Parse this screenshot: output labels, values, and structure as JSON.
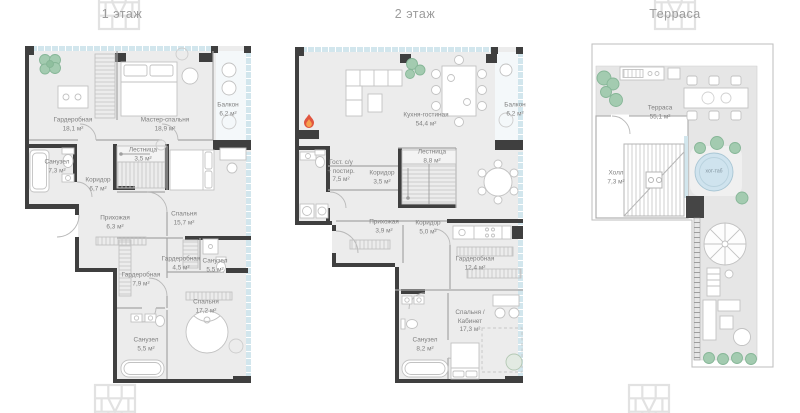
{
  "titles": {
    "floor1": "1 этаж",
    "floor2": "2 этаж",
    "terrace": "Терраса"
  },
  "floor1": {
    "rooms": [
      {
        "name": "Гардеробная",
        "area": "18,1 м²"
      },
      {
        "name": "Мастер-спальня",
        "area": "18,9 м²"
      },
      {
        "name": "Балкон",
        "area": "6,2 м²"
      },
      {
        "name": "Санузел",
        "area": "7,3 м²"
      },
      {
        "name": "Коридор",
        "area": "6,7 м²"
      },
      {
        "name": "Лестница",
        "area": "3,5 м²"
      },
      {
        "name": "Прихожая",
        "area": "6,3 м²"
      },
      {
        "name": "Спальня",
        "area": "15,7 м²"
      },
      {
        "name": "Гардеробная",
        "area": "4,5 м²"
      },
      {
        "name": "Санузел",
        "area": "5,5 м²"
      },
      {
        "name": "Гардеробная",
        "area": "7,9 м²"
      },
      {
        "name": "Спальня",
        "area": "17,2 м²"
      },
      {
        "name": "Санузел",
        "area": "5,5 м²"
      }
    ]
  },
  "floor2": {
    "rooms": [
      {
        "name": "Кухня-гостиная",
        "area": "54,4 м²"
      },
      {
        "name": "Балкон",
        "area": "6,2 м²"
      },
      {
        "name": "Гост. с/у",
        "name2": "+ постир.",
        "area": "7,5 м²"
      },
      {
        "name": "Коридор",
        "area": "3,5 м²"
      },
      {
        "name": "Лестница",
        "area": "8,8 м²"
      },
      {
        "name": "Прихожая",
        "area": "3,9 м²"
      },
      {
        "name": "Коридор",
        "area": "5,0 м²"
      },
      {
        "name": "Гардеробная",
        "area": "12,4 м²"
      },
      {
        "name": "Спальня /",
        "name2": "Кабинет",
        "area": "17,3 м²"
      },
      {
        "name": "Санузел",
        "area": "8,2 м²"
      }
    ]
  },
  "terrace": {
    "rooms": [
      {
        "name": "Терраса",
        "area": "55,1 м²"
      },
      {
        "name": "Холл",
        "area": "7,3 м²"
      }
    ],
    "hot_tub_label": "хот-таб"
  },
  "icons": {
    "fireplace": "flame-icon",
    "plants": "plant-icon",
    "hot_tub": "hot-tub-icon",
    "umbrella": "umbrella-icon",
    "watermark": "developer-logo-watermark"
  },
  "colors": {
    "wall": "#3f3f3f",
    "floor_fill": "#ececec",
    "terrace_fill": "#e6e6e6",
    "glazing_blue": "#d2e6ed",
    "plant_green": "#9cc7ab",
    "flame_red": "#e0553f",
    "flame_inner": "#f6a14e",
    "hot_tub_blue": "#cfe3ee",
    "label_text": "#7f7f7f",
    "title_text": "#9c9c9c",
    "watermark": "#e2e2e2"
  }
}
